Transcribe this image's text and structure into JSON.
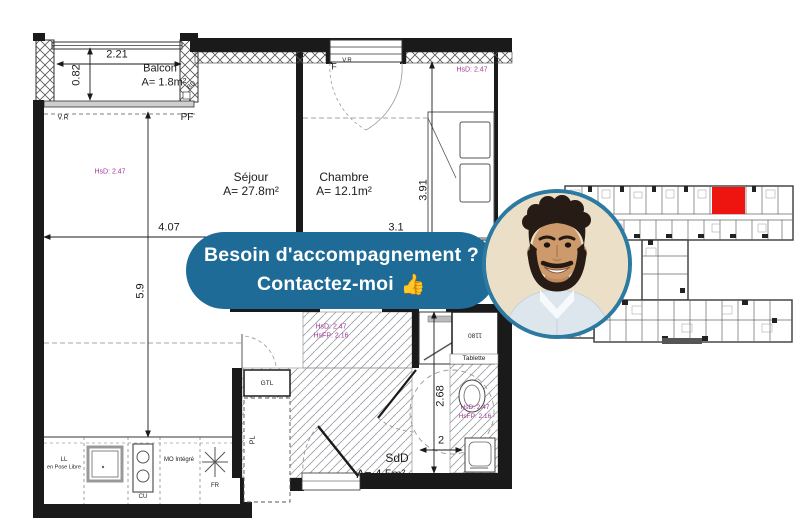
{
  "banner": {
    "line1": "Besoin d'accompagnement ?",
    "line2": "Contactez-moi",
    "thumb": "👍"
  },
  "colors": {
    "banner_bg": "#1d6b96",
    "photo_border": "#2c7aa1",
    "annot_purple": "#a03795",
    "highlight_red": "#ee1410",
    "wall_black": "#1a1a1a"
  },
  "floor_plan": {
    "rooms": {
      "balcon": {
        "name": "Balcon",
        "area": "A= 1.8m²"
      },
      "sejour": {
        "name": "Séjour",
        "area": "A= 27.8m²"
      },
      "chambre": {
        "name": "Chambre",
        "area": "A= 12.1m²"
      },
      "sdd": {
        "name": "SdD",
        "area": "A= 4.5m²"
      }
    },
    "dimensions": {
      "balcony_width": "2.21",
      "balcony_depth": "0.82",
      "sejour_width": "4.07",
      "sejour_height": "5.9",
      "chambre_height": "3.91",
      "chambre_width": "3.1",
      "sdd_height": "2.68",
      "sdd_width": "2"
    },
    "heights": {
      "sejour_hsd": "HsD: 2.47",
      "chambre_hsd": "HsD: 2.47",
      "entry_hsd": "HsD: 2.47",
      "entry_hsfp": "HsFP: 2.16",
      "wc_hsd": "HsD: 2.47",
      "wc_hsfp": "HsFP: 2.16"
    },
    "annotations": {
      "vr_balcony": "V.R",
      "pf": "PF",
      "bd": "BD",
      "f_window": "F",
      "vr_window": "V.R",
      "gtl": "GTL",
      "pl": "PL",
      "tablette": "Tablette",
      "niche_width": "1180",
      "ll_line1": "LL",
      "ll_line2": "en Pose Libre",
      "cu": "CU",
      "mo": "MO Intégré",
      "fr": "FR"
    }
  },
  "key_plan": {
    "type": "site-plan",
    "highlighted_unit": "red"
  }
}
